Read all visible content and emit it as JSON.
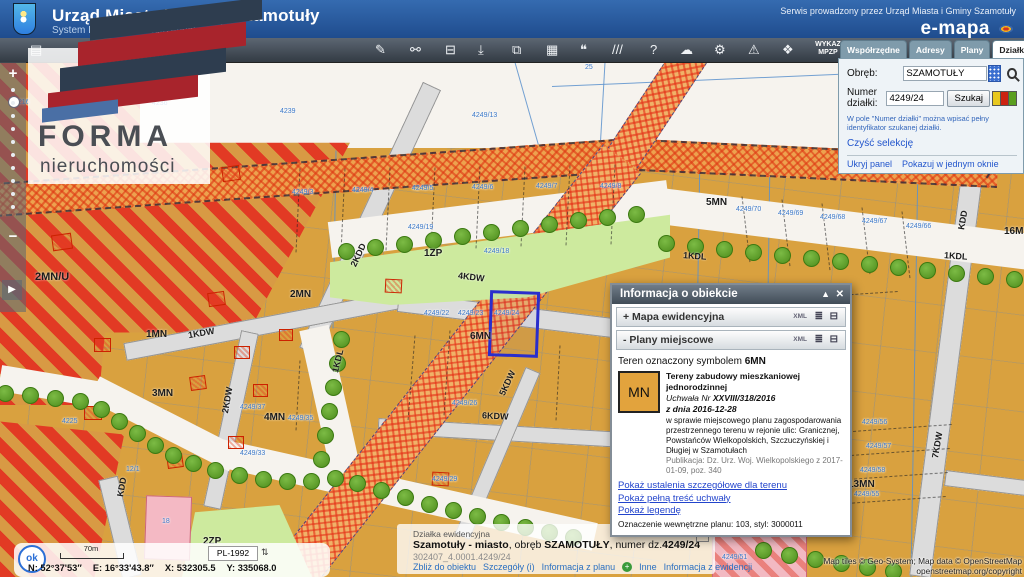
{
  "header": {
    "title": "Urząd Miasta i Gminy Szamotuły",
    "subtitle": "System Informacji Przestrzennej",
    "service_note": "Serwis prowadzony przez Urząd Miasta i Gminy Szamotuły",
    "brand": "e-mapa"
  },
  "logo": {
    "title": "FORMA",
    "subtitle": "nieruchomości"
  },
  "toolbar": {
    "wykaz_line1": "WYKAZ",
    "wykaz_line2": "MPZP",
    "icons": [
      {
        "name": "layers-icon",
        "glyph": "▤",
        "x": 30
      },
      {
        "name": "draw-icon",
        "glyph": "✎",
        "x": 375
      },
      {
        "name": "link-icon",
        "glyph": "⚯",
        "x": 410
      },
      {
        "name": "print-icon",
        "glyph": "⊟",
        "x": 445
      },
      {
        "name": "anchor-icon",
        "glyph": "⤓",
        "x": 478
      },
      {
        "name": "copy-icon",
        "glyph": "⧉",
        "x": 512
      },
      {
        "name": "grid-icon",
        "glyph": "▦",
        "x": 546
      },
      {
        "name": "comment-icon",
        "glyph": "❝",
        "x": 580
      },
      {
        "name": "measure-icon",
        "glyph": "///",
        "x": 612
      },
      {
        "name": "help-icon",
        "glyph": "?",
        "x": 650
      },
      {
        "name": "cloud-icon",
        "glyph": "☁",
        "x": 680
      },
      {
        "name": "settings-icon",
        "glyph": "⚙",
        "x": 714
      },
      {
        "name": "warning-icon",
        "glyph": "⚠",
        "x": 748
      },
      {
        "name": "share-icon",
        "glyph": "❖",
        "x": 782
      }
    ]
  },
  "panel": {
    "tabs": [
      "Współrzędne",
      "Adresy",
      "Plany",
      "Działki",
      "Obiekty"
    ],
    "active_tab": "Działki",
    "obreb_label": "Obręb:",
    "obreb_value": "SZAMOTUŁY",
    "numer_label": "Numer działki:",
    "numer_value": "4249/24",
    "szukaj_label": "Szukaj",
    "hint": "W pole \"Numer działki\" można wpisać pełny identyfikator szukanej działki.",
    "clear_selection": "Czyść selekcję",
    "hide_panel": "Ukryj panel",
    "single_window": "Pokazuj w jednym oknie",
    "flag_colors": [
      "#e8c81f",
      "#cc2211",
      "#5a9e1f"
    ]
  },
  "popup": {
    "title": "Informacja o obiekcie",
    "sections": [
      {
        "prefix": "+",
        "label": "Mapa ewidencyjna"
      },
      {
        "prefix": "-",
        "label": "Plany miejscowe"
      }
    ],
    "xml_label": "XML",
    "teren_prefix": "Teren oznaczony symbolem ",
    "teren_symbol": "6MN",
    "swatch_label": "MN",
    "plan_title": "Tereny zabudowy mieszkaniowej jednorodzinnej",
    "uchwala_prefix": "Uchwała Nr ",
    "uchwala_nr": "XXVIII/318/2016",
    "z_dnia": "z dnia 2016-12-28",
    "description": "w sprawie miejscowego planu zagospodarowania przestrzennego terenu w rejonie ulic: Granicznej, Powstańców Wielkopolskich, Szczuczyńskiej i Długiej w Szamotułach",
    "publikacja": "Publikacja: Dz. Urz. Woj. Wielkopolskiego z 2017-01-09, poz. 340",
    "links": [
      "Pokaż ustalenia szczegółowe dla terenu",
      "Pokaż pełną treść uchwały",
      "Pokaż legendę"
    ],
    "oznaczenie": "Oznaczenie wewnętrzne planu: 103, styl: 3000011"
  },
  "feature_bar": {
    "kind": "Działka ewidencyjna",
    "bold1": "Szamotuły - miasto",
    "mid1": ", obręb ",
    "bold2": "SZAMOTUŁY",
    "mid2": ", numer dz.",
    "bold3": "4249/24",
    "ident": "302407_4.0001.4249/24",
    "links_left": [
      "Zbliż do obiektu",
      "Szczegóły (i)",
      "Informacja z planu"
    ],
    "links_right": [
      "Inne",
      "Informacja z ewidencji"
    ]
  },
  "status": {
    "ok_label": "ok",
    "scale_label": "70m",
    "crs": "PL-1992",
    "n": "N: 52°37'53″",
    "e": "E: 16°33'43.8″",
    "x": "X: 532305.5",
    "y": "Y: 335068.0"
  },
  "attribution": {
    "line1": "Map tiles © Geo-System; Map data © OpenStreetMap",
    "line2": "openstreetmap.org/copyright"
  },
  "map": {
    "selected_parcel": {
      "x": 489,
      "y": 229,
      "w": 44,
      "h": 60,
      "r": 2
    },
    "zone_labels": [
      {
        "t": "2MN/U",
        "x": 35,
        "y": 209,
        "s": 11,
        "r": 0
      },
      {
        "t": "2MN",
        "x": 290,
        "y": 227,
        "s": 10,
        "r": 0
      },
      {
        "t": "1MN",
        "x": 146,
        "y": 267,
        "s": 10,
        "r": 0
      },
      {
        "t": "3MN",
        "x": 152,
        "y": 326,
        "s": 10,
        "r": 0
      },
      {
        "t": "4MN",
        "x": 264,
        "y": 350,
        "s": 10,
        "r": 0
      },
      {
        "t": "6MN",
        "x": 470,
        "y": 269,
        "s": 10,
        "r": 0
      },
      {
        "t": "5MN",
        "x": 706,
        "y": 135,
        "s": 10,
        "r": 0
      },
      {
        "t": "13MN",
        "x": 848,
        "y": 417,
        "s": 10,
        "r": 0
      },
      {
        "t": "16MN",
        "x": 1004,
        "y": 164,
        "s": 10,
        "r": 0
      },
      {
        "t": "1ZP",
        "x": 424,
        "y": 186,
        "s": 10,
        "r": 0
      },
      {
        "t": "2ZP",
        "x": 203,
        "y": 474,
        "s": 10,
        "r": 0
      },
      {
        "t": "1KDL",
        "x": 683,
        "y": 189,
        "s": 9,
        "r": 4
      },
      {
        "t": "1KDL",
        "x": 944,
        "y": 189,
        "s": 9,
        "r": 4
      },
      {
        "t": "1KDL",
        "x": 326,
        "y": 294,
        "s": 9,
        "r": -76
      },
      {
        "t": "1KDW",
        "x": 188,
        "y": 266,
        "s": 9,
        "r": -10
      },
      {
        "t": "4KDW",
        "x": 458,
        "y": 210,
        "s": 9,
        "r": 7
      },
      {
        "t": "2KDD",
        "x": 346,
        "y": 188,
        "s": 9,
        "r": -65
      },
      {
        "t": "2KDW",
        "x": 214,
        "y": 333,
        "s": 9,
        "r": -80
      },
      {
        "t": "5KDW",
        "x": 494,
        "y": 316,
        "s": 9,
        "r": -65
      },
      {
        "t": "6KDW",
        "x": 482,
        "y": 349,
        "s": 9,
        "r": 3
      },
      {
        "t": "7KDW",
        "x": 924,
        "y": 378,
        "s": 9,
        "r": -80
      },
      {
        "t": "KDD",
        "x": 953,
        "y": 153,
        "s": 9,
        "r": -80
      },
      {
        "t": "KDD",
        "x": 112,
        "y": 420,
        "s": 9,
        "r": -80
      }
    ],
    "parcel_labels": [
      {
        "t": "4216",
        "x": 14,
        "y": 37
      },
      {
        "t": "4235",
        "x": 94,
        "y": 38
      },
      {
        "t": "4236",
        "x": 152,
        "y": 38
      },
      {
        "t": "4239",
        "x": 280,
        "y": 46
      },
      {
        "t": "4249/13",
        "x": 472,
        "y": 50
      },
      {
        "t": "25",
        "x": 585,
        "y": 2
      },
      {
        "t": "4249/19",
        "x": 408,
        "y": 162
      },
      {
        "t": "4249/18",
        "x": 484,
        "y": 186
      },
      {
        "t": "4249/3",
        "x": 292,
        "y": 127
      },
      {
        "t": "4249/4",
        "x": 352,
        "y": 125
      },
      {
        "t": "4249/5",
        "x": 412,
        "y": 123
      },
      {
        "t": "4249/6",
        "x": 472,
        "y": 122
      },
      {
        "t": "4249/7",
        "x": 536,
        "y": 121
      },
      {
        "t": "4249/8",
        "x": 600,
        "y": 121
      },
      {
        "t": "4249/70",
        "x": 736,
        "y": 144
      },
      {
        "t": "4249/69",
        "x": 778,
        "y": 148
      },
      {
        "t": "4249/68",
        "x": 820,
        "y": 152
      },
      {
        "t": "4249/67",
        "x": 862,
        "y": 156
      },
      {
        "t": "4249/66",
        "x": 906,
        "y": 161
      },
      {
        "t": "4249/22",
        "x": 424,
        "y": 248
      },
      {
        "t": "4249/23",
        "x": 458,
        "y": 248
      },
      {
        "t": "4249/24",
        "x": 494,
        "y": 248
      },
      {
        "t": "4249/37",
        "x": 240,
        "y": 342
      },
      {
        "t": "4249/35",
        "x": 288,
        "y": 353
      },
      {
        "t": "4249/33",
        "x": 240,
        "y": 388
      },
      {
        "t": "4249/26",
        "x": 452,
        "y": 338
      },
      {
        "t": "4249/29",
        "x": 432,
        "y": 414
      },
      {
        "t": "4249/56",
        "x": 862,
        "y": 357
      },
      {
        "t": "4249/57",
        "x": 866,
        "y": 381
      },
      {
        "t": "4249/58",
        "x": 860,
        "y": 405
      },
      {
        "t": "4249/55",
        "x": 854,
        "y": 429
      },
      {
        "t": "4249/51",
        "x": 722,
        "y": 492
      },
      {
        "t": "4225",
        "x": 62,
        "y": 356
      },
      {
        "t": "12/1",
        "x": 126,
        "y": 404
      },
      {
        "t": "18",
        "x": 162,
        "y": 456
      }
    ],
    "bars": [
      [
        432,
        24,
        308,
        290,
        20,
        "road"
      ],
      [
        125,
        290,
        400,
        238,
        18,
        "road"
      ],
      [
        398,
        240,
        712,
        278,
        20,
        "road"
      ],
      [
        250,
        270,
        212,
        446,
        18,
        "road"
      ],
      [
        378,
        364,
        625,
        378,
        16,
        "road"
      ],
      [
        533,
        308,
        462,
        475,
        16,
        "road"
      ],
      [
        972,
        113,
        920,
        515,
        22,
        "road"
      ],
      [
        108,
        416,
        132,
        515,
        20,
        "road"
      ],
      [
        945,
        416,
        1026,
        426,
        16,
        "road"
      ],
      [
        0,
        316,
        108,
        334,
        26,
        "wroad"
      ],
      [
        94,
        326,
        235,
        398,
        26,
        "wroad"
      ],
      [
        220,
        391,
        595,
        475,
        28,
        "wroad"
      ],
      [
        314,
        266,
        346,
        410,
        30,
        "wroad"
      ],
      [
        330,
        178,
        668,
        136,
        36,
        "wroad"
      ],
      [
        652,
        143,
        1030,
        190,
        36,
        "wroad"
      ],
      [
        -5,
        136,
        645,
        90,
        30,
        "band"
      ],
      [
        640,
        91,
        998,
        108,
        28,
        "band"
      ],
      [
        975,
        106,
        1036,
        18,
        26,
        "band"
      ],
      [
        700,
        -22,
        622,
        96,
        34,
        "corr"
      ],
      [
        622,
        96,
        298,
        506,
        46,
        "corr"
      ]
    ],
    "blue_lines": [
      [
        515,
        0,
        540,
        88
      ],
      [
        552,
        24,
        1024,
        4
      ],
      [
        700,
        88,
        694,
        462
      ],
      [
        770,
        93,
        764,
        515
      ],
      [
        918,
        100,
        911,
        515
      ],
      [
        336,
        88,
        333,
        266
      ],
      [
        605,
        0,
        600,
        88
      ]
    ],
    "dash_lines": [
      [
        300,
        106,
        296,
        190
      ],
      [
        345,
        106,
        341,
        190
      ],
      [
        390,
        105,
        386,
        188
      ],
      [
        435,
        105,
        431,
        187
      ],
      [
        480,
        104,
        476,
        186
      ],
      [
        525,
        104,
        521,
        184
      ],
      [
        570,
        103,
        566,
        183
      ],
      [
        615,
        102,
        611,
        182
      ],
      [
        742,
        134,
        750,
        200
      ],
      [
        782,
        137,
        790,
        204
      ],
      [
        822,
        141,
        830,
        208
      ],
      [
        862,
        145,
        870,
        212
      ],
      [
        902,
        149,
        910,
        216
      ],
      [
        838,
        370,
        952,
        362
      ],
      [
        836,
        394,
        950,
        386
      ],
      [
        834,
        418,
        948,
        410
      ],
      [
        832,
        442,
        946,
        434
      ],
      [
        762,
        238,
        898,
        229
      ],
      [
        450,
        268,
        444,
        353
      ],
      [
        415,
        273,
        408,
        358
      ],
      [
        300,
        298,
        296,
        368
      ],
      [
        560,
        283,
        556,
        358
      ]
    ],
    "trees": [
      [
        345,
        188
      ],
      [
        374,
        184
      ],
      [
        403,
        181
      ],
      [
        432,
        177
      ],
      [
        461,
        173
      ],
      [
        490,
        169
      ],
      [
        519,
        165
      ],
      [
        548,
        161
      ],
      [
        577,
        157
      ],
      [
        606,
        154
      ],
      [
        635,
        151
      ],
      [
        665,
        180
      ],
      [
        694,
        183
      ],
      [
        723,
        186
      ],
      [
        752,
        189
      ],
      [
        781,
        192
      ],
      [
        810,
        195
      ],
      [
        839,
        198
      ],
      [
        868,
        201
      ],
      [
        897,
        204
      ],
      [
        926,
        207
      ],
      [
        955,
        210
      ],
      [
        984,
        213
      ],
      [
        1013,
        216
      ],
      [
        4,
        330
      ],
      [
        29,
        332
      ],
      [
        54,
        335
      ],
      [
        79,
        338
      ],
      [
        100,
        346
      ],
      [
        118,
        358
      ],
      [
        136,
        370
      ],
      [
        154,
        382
      ],
      [
        172,
        392
      ],
      [
        192,
        400
      ],
      [
        214,
        407
      ],
      [
        238,
        412
      ],
      [
        262,
        416
      ],
      [
        286,
        418
      ],
      [
        310,
        418
      ],
      [
        334,
        415
      ],
      [
        356,
        420
      ],
      [
        380,
        427
      ],
      [
        404,
        434
      ],
      [
        428,
        441
      ],
      [
        452,
        447
      ],
      [
        476,
        453
      ],
      [
        500,
        459
      ],
      [
        524,
        464
      ],
      [
        548,
        469
      ],
      [
        572,
        474
      ],
      [
        320,
        396
      ],
      [
        324,
        372
      ],
      [
        328,
        348
      ],
      [
        332,
        324
      ],
      [
        336,
        300
      ],
      [
        340,
        276
      ],
      [
        762,
        487
      ],
      [
        788,
        492
      ],
      [
        814,
        496
      ],
      [
        840,
        500
      ],
      [
        866,
        504
      ],
      [
        892,
        508
      ]
    ],
    "buildings": [
      [
        222,
        104,
        16,
        13,
        -8
      ],
      [
        208,
        230,
        15,
        12,
        -8
      ],
      [
        190,
        314,
        14,
        12,
        -8
      ],
      [
        167,
        392,
        14,
        12,
        -8
      ],
      [
        94,
        276,
        15,
        12,
        0
      ],
      [
        84,
        344,
        16,
        12,
        0
      ],
      [
        234,
        284,
        14,
        11,
        0
      ],
      [
        253,
        322,
        13,
        11,
        0
      ],
      [
        228,
        374,
        14,
        11,
        0
      ],
      [
        385,
        217,
        15,
        12,
        3
      ],
      [
        432,
        410,
        15,
        12,
        3
      ],
      [
        279,
        267,
        12,
        10,
        0
      ],
      [
        52,
        172,
        18,
        14,
        -8
      ]
    ],
    "colors": {
      "orange": "#d9a13f",
      "red": "#e23a24",
      "road": "#dcdcdc",
      "green_zone": "#cdea9e",
      "tree": "#4e8d1d",
      "blue_line": "#6a9fd4",
      "parcel_label": "#3b78c8",
      "selected": "#2a2ecc",
      "pink": "#f4b9c4"
    }
  }
}
